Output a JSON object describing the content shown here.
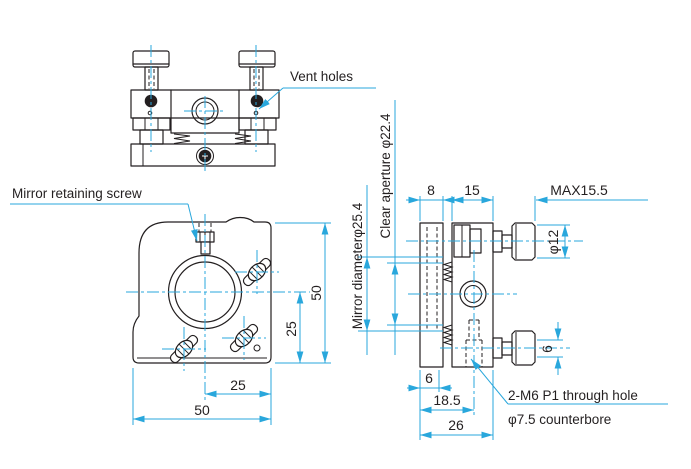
{
  "drawing": {
    "annotations": {
      "vent_holes": "Vent holes",
      "mirror_retaining_screw": "Mirror retaining screw",
      "through_hole": "2-M6 P1 through hole",
      "counterbore": "φ7.5 counterbore"
    },
    "side_view": {
      "clear_aperture": "Clear aperture φ22.4",
      "mirror_diameter": "Mirror diameterφ25.4",
      "dim_front_plate": "8",
      "dim_body": "15",
      "dim_max_protrusion": "MAX15.5",
      "dim_knob_diameter": "φ12",
      "dim_knob_travel": "6",
      "dim_mirror_recess": "6",
      "dim_hole_offset": "18.5",
      "dim_depth": "26"
    },
    "front_view": {
      "dim_height": "50",
      "dim_center_to_bottom": "25",
      "dim_center_to_right_edge": "25",
      "dim_width": "50"
    },
    "colors": {
      "line": "#231f20",
      "accent": "#29a7dc"
    }
  }
}
